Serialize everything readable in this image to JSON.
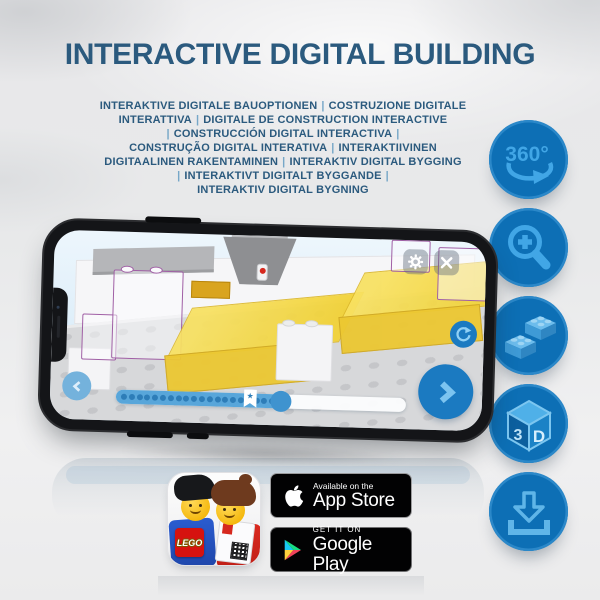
{
  "header": {
    "title": "INTERACTIVE DIGITAL BUILDING",
    "subtitle_lines": [
      "INTERAKTIVE DIGITALE BAUOPTIONEN | COSTRUZIONE DIGITALE",
      "INTERATTIVA | DIGITALE DE CONSTRUCTION INTERACTIVE",
      "| CONSTRUCCIÓN DIGITAL INTERACTIVA |",
      "CONSTRUÇÃO DIGITAL INTERATIVA | INTERAKTIIVINEN",
      "DIGITAALINEN RAKENTAMINEN | INTERAKTIV DIGITAL BYGGING",
      "| INTERAKTIVT DIGITALT BYGGANDE |",
      "INTERAKTIV DIGITAL BYGNING"
    ],
    "title_color": "#2b5a7e",
    "separator_color": "#76a7c8"
  },
  "feature_buttons": [
    {
      "id": "rotate-360",
      "label": "360°"
    },
    {
      "id": "zoom-in",
      "label": ""
    },
    {
      "id": "brick-options",
      "label": ""
    },
    {
      "id": "view-3d",
      "face_left": "3",
      "face_right": "D"
    },
    {
      "id": "download",
      "label": ""
    }
  ],
  "feature_button_colors": {
    "circle": "#0d6fb5",
    "glyph": "#41a6e6"
  },
  "phone": {
    "screen_controls": {
      "settings": "gear",
      "close": "x",
      "rotate_model": "circular-arrow",
      "next_step": "chevron-right",
      "previous_step": "chevron-left"
    },
    "progress": {
      "dot_count": 22,
      "fill_percent": 57,
      "knob_percent": 57,
      "bookmark_percent": 44,
      "bookmark_glyph": "★"
    }
  },
  "app_icon": {
    "logo_text": "LEGO"
  },
  "badges": {
    "app_store": {
      "line1": "Available on the",
      "line2": "App Store"
    },
    "google_play": {
      "line1": "GET IT ON",
      "line2": "Google Play"
    }
  }
}
